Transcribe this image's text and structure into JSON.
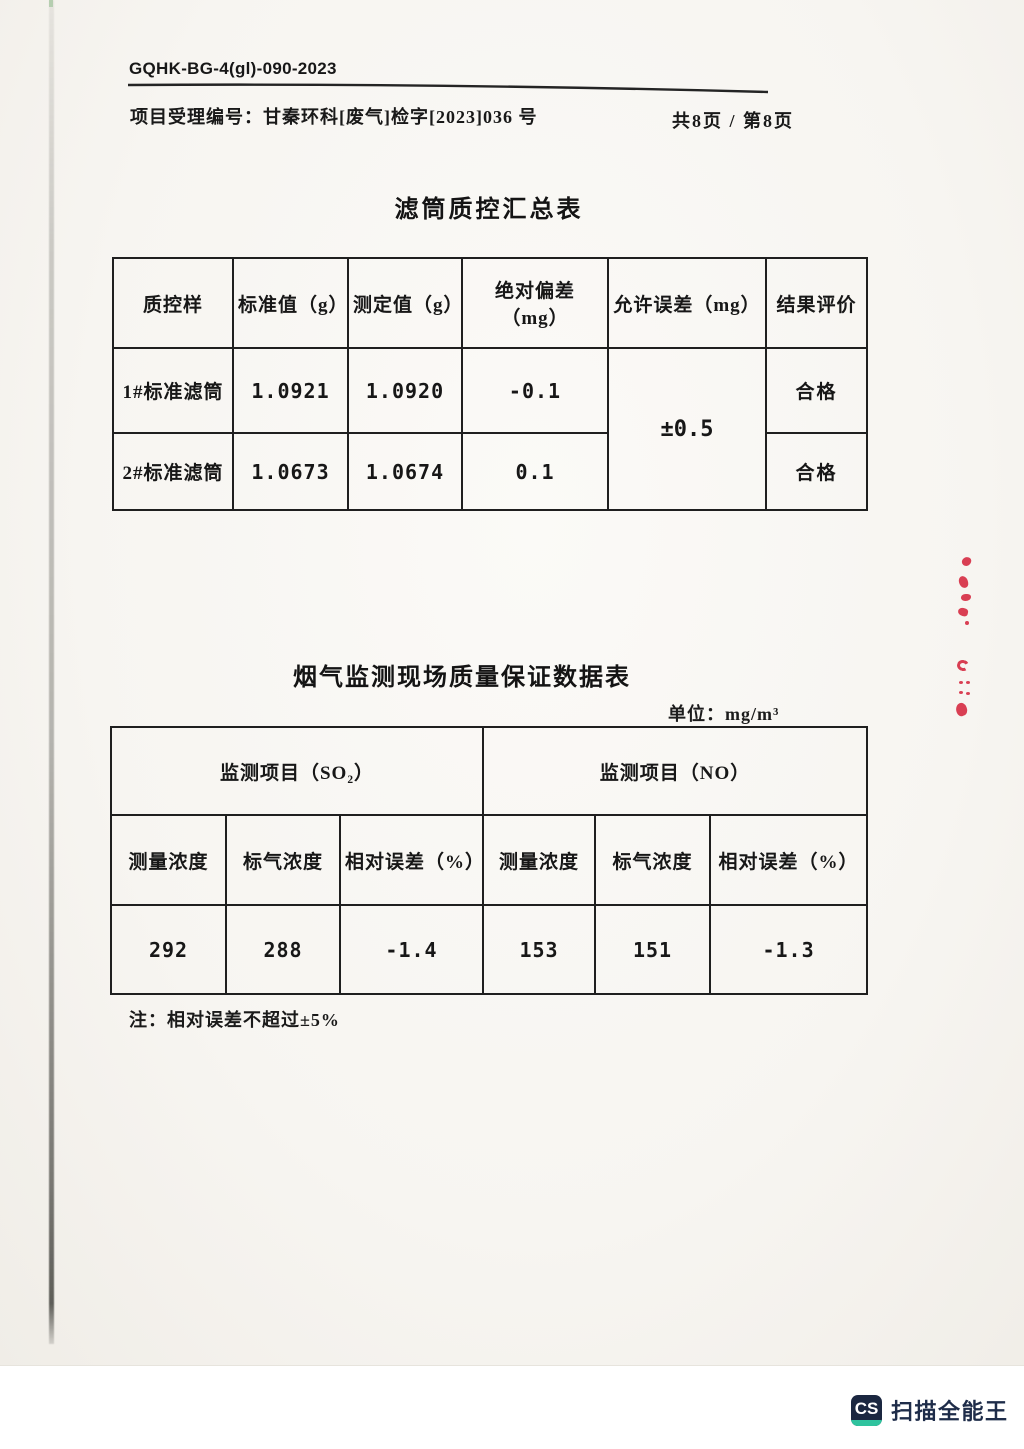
{
  "header": {
    "doc_code": "GQHK-BG-4(gl)-090-2023",
    "project_line": "项目受理编号：甘秦环科[废气]检字[2023]036 号",
    "page_info": "共8页 / 第8页"
  },
  "filter_table": {
    "title": "滤筒质控汇总表",
    "columns": [
      "质控样",
      "标准值（g）",
      "测定值（g）",
      "绝对偏差（mg）",
      "允许误差（mg）",
      "结果评价"
    ],
    "rows": [
      {
        "sample": "1#标准滤筒",
        "standard_value": "1.0921",
        "measured_value": "1.0920",
        "absolute_deviation": "-0.1",
        "result": "合格"
      },
      {
        "sample": "2#标准滤筒",
        "standard_value": "1.0673",
        "measured_value": "1.0674",
        "absolute_deviation": "0.1",
        "result": "合格"
      }
    ],
    "allowed_error": "±0.5"
  },
  "qa_table": {
    "title": "烟气监测现场质量保证数据表",
    "unit": "单位：mg/m³",
    "groups": [
      "监测项目（SO₂）",
      "监测项目（NO）"
    ],
    "columns": [
      "测量浓度",
      "标气浓度",
      "相对误差（%）",
      "测量浓度",
      "标气浓度",
      "相对误差（%）"
    ],
    "values": [
      "292",
      "288",
      "-1.4",
      "153",
      "151",
      "-1.3"
    ],
    "note": "注：相对误差不超过±5%"
  },
  "watermark": {
    "logo_text": "CS",
    "app_name": "扫描全能王"
  }
}
